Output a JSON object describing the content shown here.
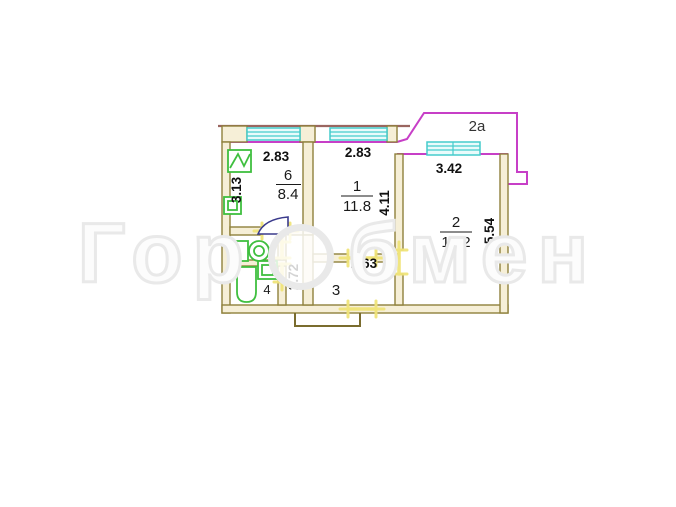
{
  "watermark": {
    "prefix": "Гор",
    "suffix": "бмен"
  },
  "plan": {
    "balcony": {
      "label": "2а"
    },
    "rooms": {
      "kitchen": {
        "number": "6",
        "area": "8.4"
      },
      "room1": {
        "number": "1",
        "area": "11.8"
      },
      "room2": {
        "number": "2",
        "area": "19.2"
      },
      "hallway": {
        "number": "3"
      },
      "bathroom": {
        "number": "4"
      },
      "toilet": {
        "number": "5"
      }
    },
    "dimensions": {
      "kitchen_width": "2.83",
      "room1_width": "2.83",
      "room2_width": "3.42",
      "kitchen_depth": "3.13",
      "room1_depth": "4.11",
      "room2_depth": "5.54",
      "corridor_length": "2.72",
      "hallway_width": "2.63"
    },
    "colors": {
      "wall_stroke": "#8f813c",
      "wall_fill": "#f6efd7",
      "window": "#45cccc",
      "fixture_green": "#3fbf3f",
      "door_yellow": "#f0e47a",
      "outer_contour_magenta": "#c73fc7",
      "upper_floor_line_brown": "#9a6660",
      "door_swing_navy": "#3a3a8c",
      "label_black": "#111111"
    }
  }
}
